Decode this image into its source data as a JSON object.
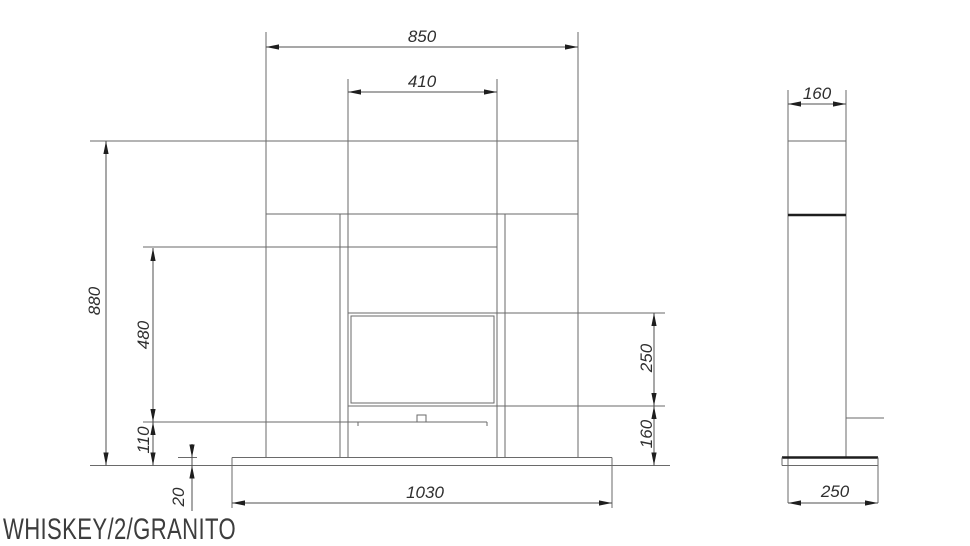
{
  "title": "WHISKEY/2/GRANITO",
  "front_view": {
    "dim_overall_width_mm": "850",
    "dim_firebox_width_mm": "410",
    "dim_overall_height_mm": "880",
    "dim_recess_height_mm": "480",
    "dim_burner_zone_mm": "110",
    "dim_hearth_thickness_mm": "20",
    "dim_hearth_width_mm": "1030",
    "dim_window_height_mm": "250",
    "dim_lower_zone_mm": "160"
  },
  "side_view": {
    "dim_depth_mm": "160",
    "dim_hearth_depth_mm": "250"
  },
  "colors": {
    "background": "#ffffff",
    "line": "#6a6a6a",
    "dimension_line": "#4f4f4f",
    "thick_line": "#1e1e1e",
    "dimension_text": "#2f2f2f",
    "title_text": "#3d3d3d"
  }
}
